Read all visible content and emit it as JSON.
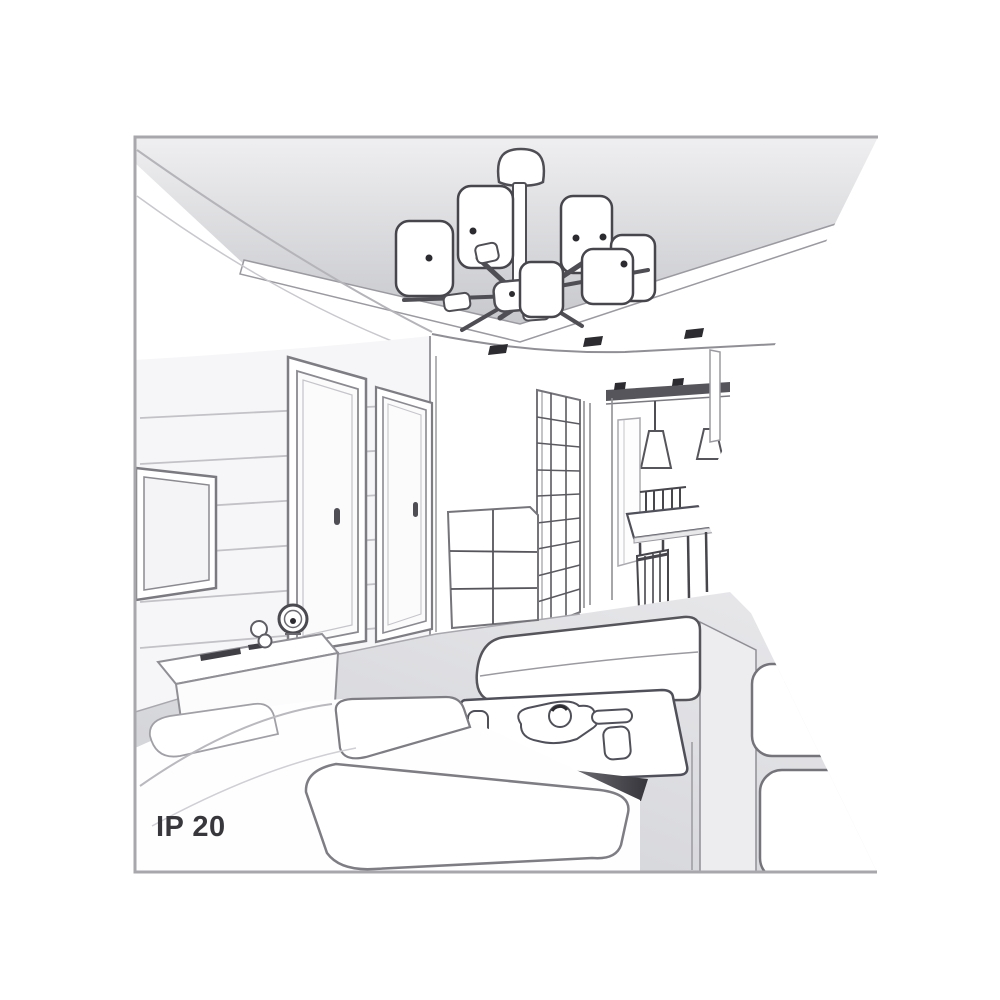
{
  "illustration": {
    "ip_rating_label": "IP 20",
    "subject": "interior-room-line-art-with-ceiling-chandelier",
    "colors": {
      "background": "#ffffff",
      "frame_border": "#a7a7ac",
      "line_dark": "#46464c",
      "line_mid": "#8f8f95",
      "line_light": "#c5c5ca",
      "ceiling_shade_top": "#eeeef0",
      "ceiling_shade_bottom": "#c6c7cb",
      "floor_shade": "#d4d5d9",
      "detail_dark": "#2b2b30",
      "label_text": "#38383c"
    }
  }
}
